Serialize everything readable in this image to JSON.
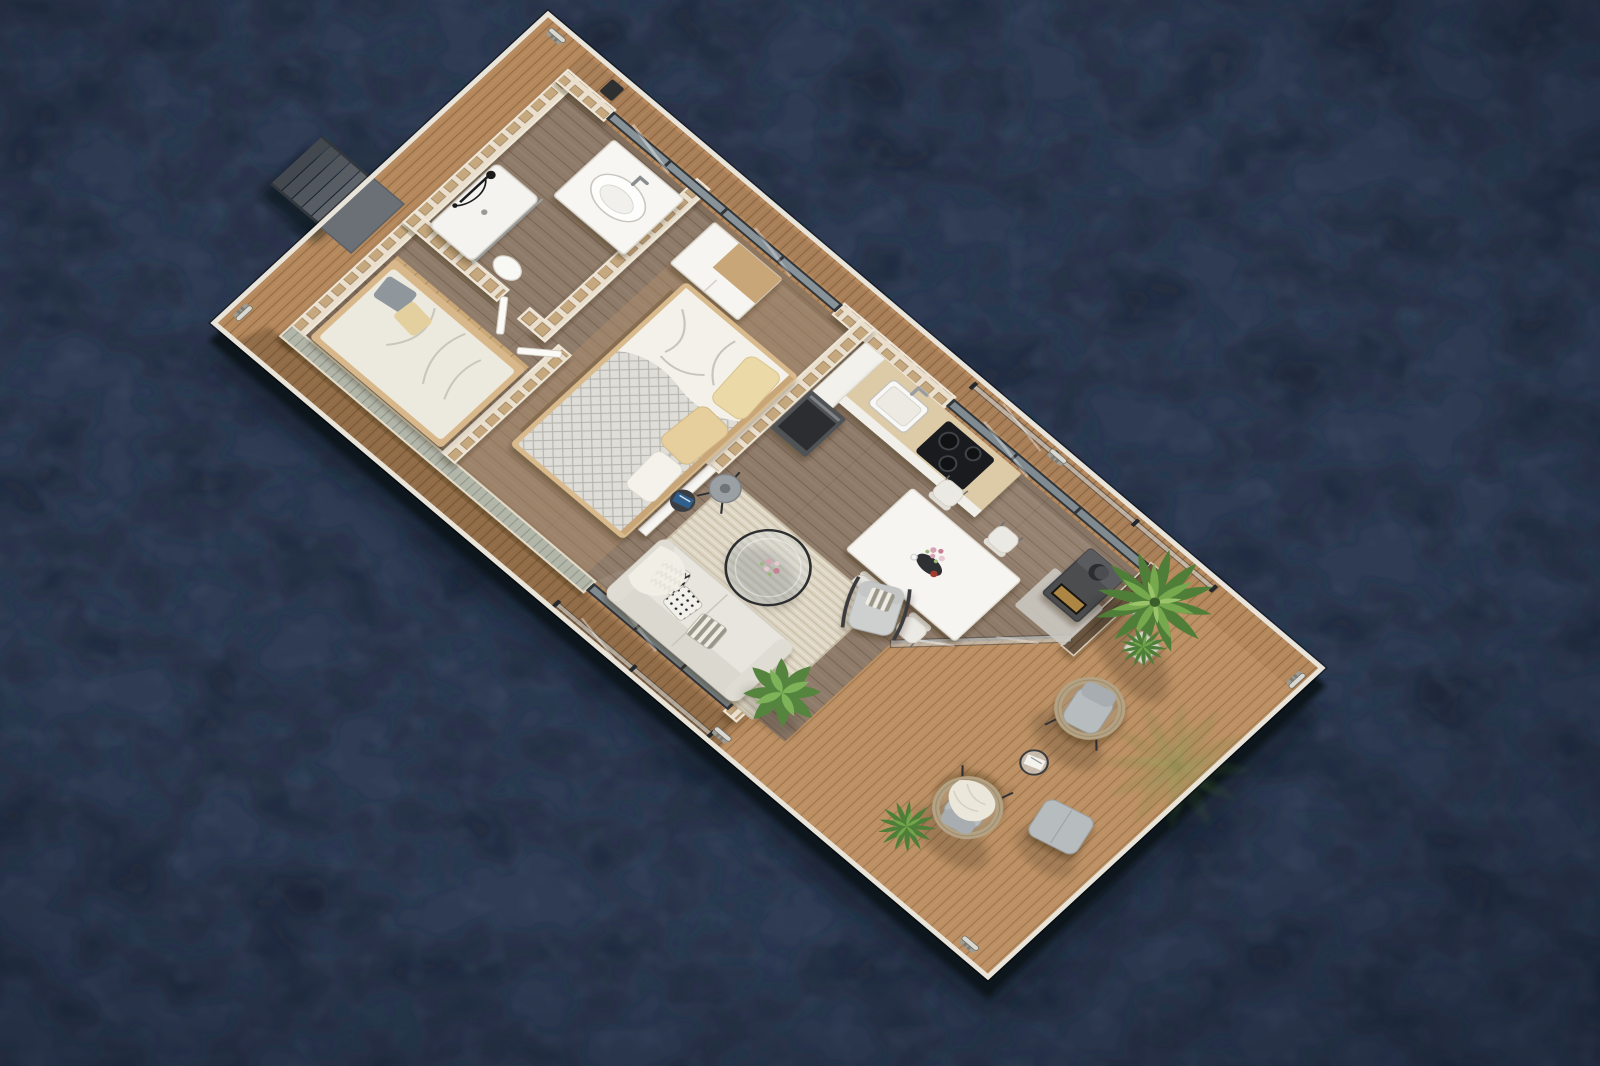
{
  "scene": {
    "type": "3d-architectural-render",
    "subject": "houseboat floating home - aerial cutaway floor plan",
    "view": "top-down oblique",
    "environment": "open dark water",
    "rooms": [
      "bathroom",
      "bunk-nook",
      "bedroom",
      "kitchen",
      "dining-area",
      "living-room",
      "aft-sun-deck",
      "bow-deck"
    ],
    "furnishings": [
      "boarding-stairs",
      "shower",
      "sink-vanity",
      "toilet",
      "daybed",
      "wardrobe-dresser",
      "double-bed",
      "kitchen-counter",
      "sink",
      "cooktop",
      "oven",
      "dining-table",
      "dining-chairs",
      "sofa",
      "coffee-table",
      "armchair",
      "floor-lamp",
      "side-table",
      "wood-stove",
      "glass-balustrade",
      "wicker-lounge-chairs",
      "ottoman",
      "outdoor-side-table",
      "potted-palm",
      "potted-grass",
      "broadleaf-plant",
      "fern-plant",
      "mooring-cleats"
    ]
  },
  "colors": {
    "water": "#2e3b52",
    "water_patch_dark": "#1a2334",
    "water_patch_light": "#51617a",
    "hull": "#10151d",
    "deck": "#b5885c",
    "deck_ledge": "#a87e57",
    "rim": "#e9e4d9",
    "floor": "#8f7b69",
    "floor_bedroom": "#b08f6d",
    "wall_face": "#f4f2ec",
    "wall_cell": "#c6a87e",
    "sage_siding": "#b2b6a9",
    "dark_slats": "#6b5640",
    "glass": "#cfe0e8",
    "glass_frame": "#30353a",
    "sofa": "#e7e5de",
    "rug": "#ded6c3",
    "table": "#f6f5f1",
    "duvet": "#deddd7",
    "pillow": "#ecd9a8",
    "wood_trim": "#c8a678",
    "counter": "#ddcba8",
    "cooktop": "#191b1e",
    "appliance": "#4f5256",
    "stove": "#4b4d50",
    "stove_glow": "#c99a4e",
    "plant": "#76a94e",
    "plant_dark": "#4f7e38",
    "plant_light": "#9cc46a",
    "pot": "#c9c4b6",
    "wicker": "#b3a283",
    "outdoor_cushion": "#b7bcbe",
    "lamp": "#9aa0a3",
    "magazine": "#2f5f8d",
    "stairs": "#575d63",
    "cleat": "#d9d9d2",
    "blanket": "#f3f1ea"
  }
}
